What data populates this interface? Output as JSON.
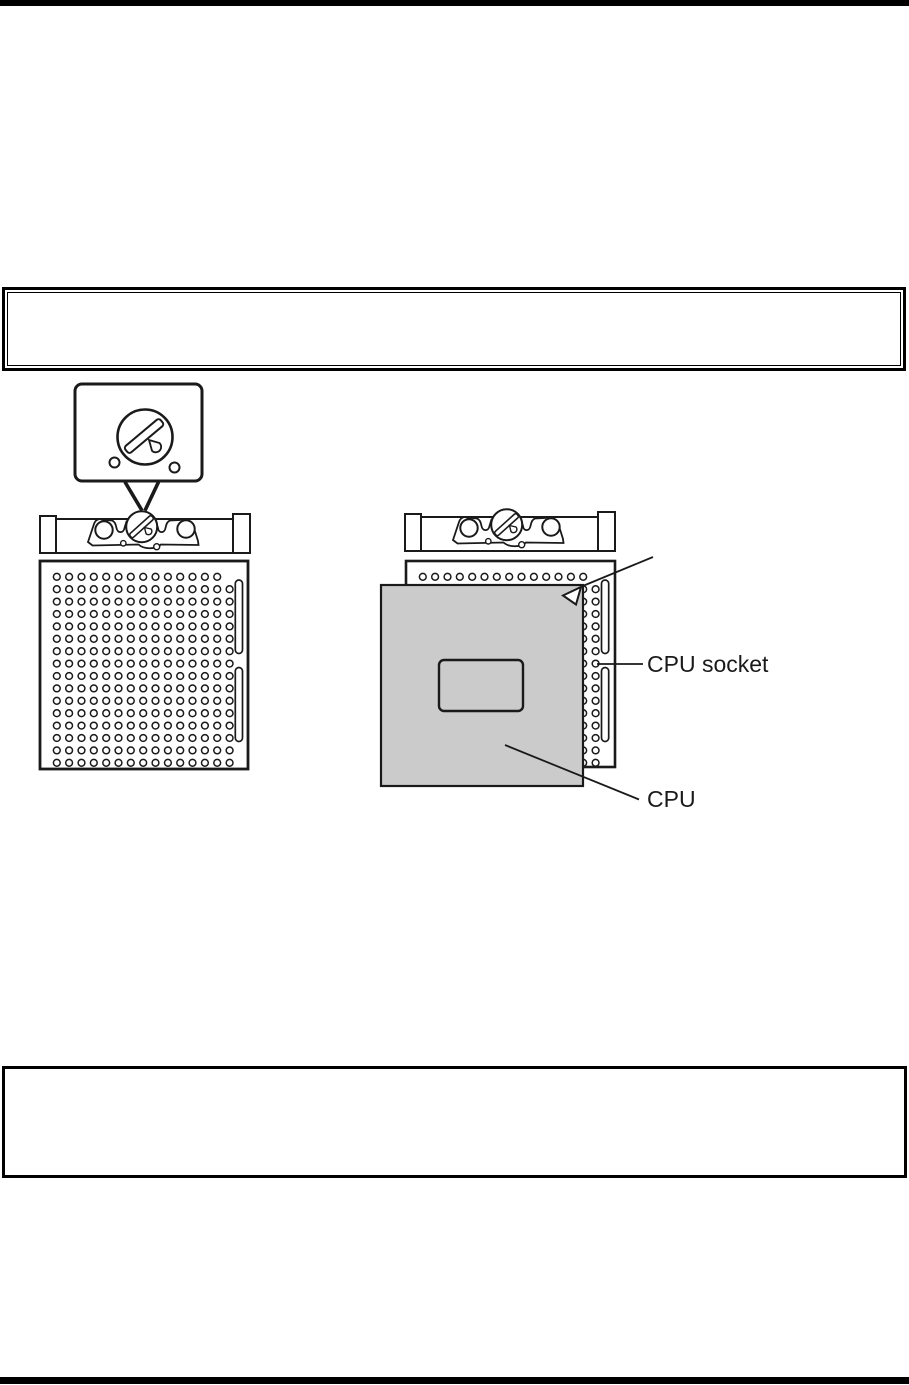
{
  "colors": {
    "ink": "#1a1a1a",
    "cpu_fill": "#cbcbcb",
    "paper": "#ffffff"
  },
  "figure": {
    "labels": {
      "cpu_socket": "CPU socket",
      "cpu": "CPU"
    }
  }
}
